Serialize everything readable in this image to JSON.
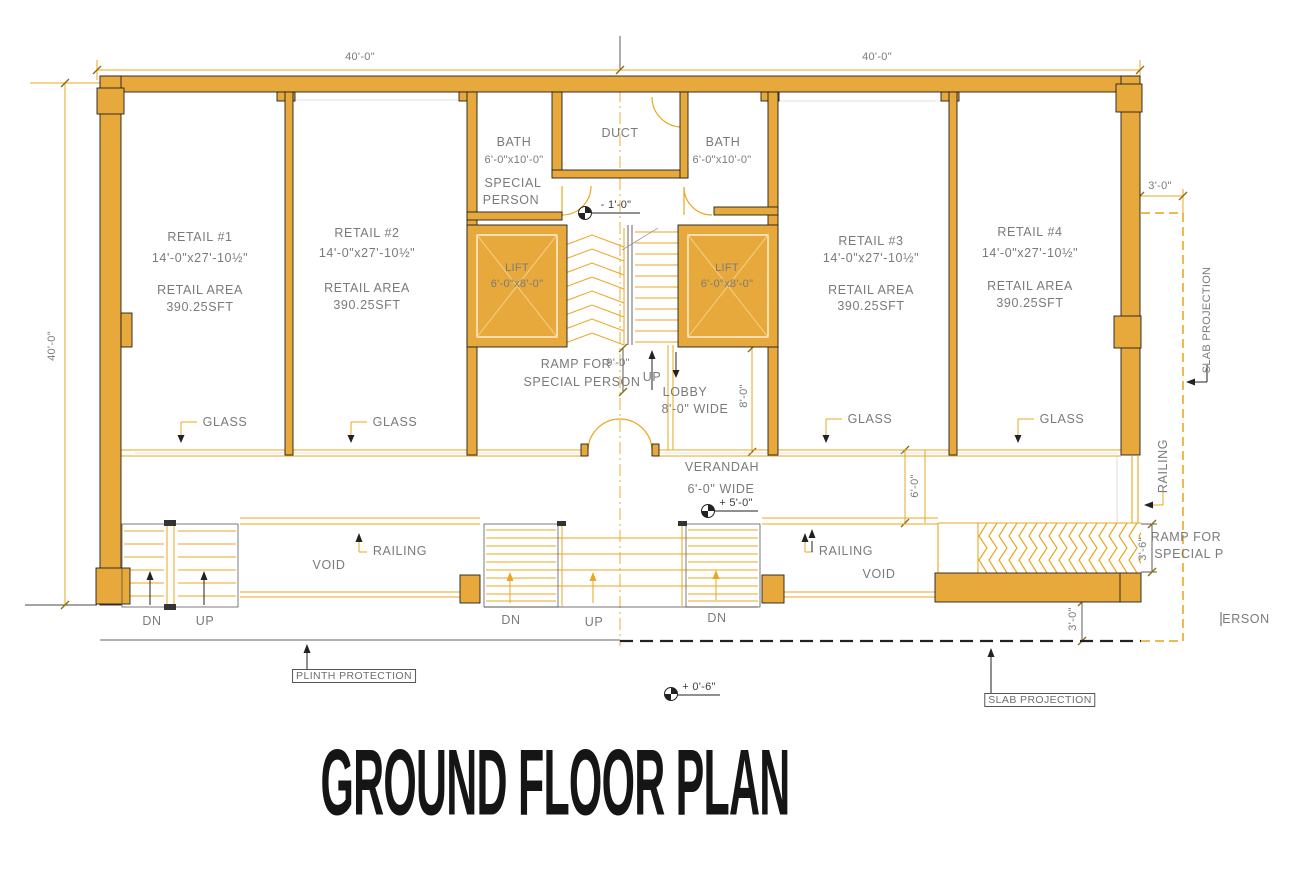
{
  "title": "GROUND FLOOR PLAN",
  "colors": {
    "wall": "#E8A93C",
    "line": "#EAA61F",
    "text": "#7A7A7A",
    "ink": "#1B1B1B"
  },
  "dimensions": {
    "top_left": "40'-0\"",
    "top_right": "40'-0\"",
    "left_side": "40'-0\"",
    "slab_offset_top": "3'-0\"",
    "slab_offset_bottom": "3'-0\"",
    "ramp_right_width": "3'-6\"",
    "verandah_depth": "6'-0\"",
    "lobby_depth": "8'-0\"",
    "ramp_length": "9'-0\""
  },
  "rooms": {
    "retail1": {
      "name": "RETAIL #1",
      "size": "14'-0\"x27'-10½\"",
      "area_label": "RETAIL AREA",
      "area": "390.25SFT"
    },
    "retail2": {
      "name": "RETAIL #2",
      "size": "14'-0\"x27'-10½\"",
      "area_label": "RETAIL AREA",
      "area": "390.25SFT"
    },
    "retail3": {
      "name": "RETAIL #3",
      "size": "14'-0\"x27'-10½\"",
      "area_label": "RETAIL AREA",
      "area": "390.25SFT"
    },
    "retail4": {
      "name": "RETAIL #4",
      "size": "14'-0\"x27'-10½\"",
      "area_label": "RETAIL AREA",
      "area": "390.25SFT"
    },
    "bath_left": {
      "name": "BATH",
      "size": "6'-0\"x10'-0\"",
      "note_line1": "SPECIAL",
      "note_line2": "PERSON"
    },
    "bath_right": {
      "name": "BATH",
      "size": "6'-0\"x10'-0\""
    },
    "duct": {
      "name": "DUCT"
    },
    "lift_left": {
      "name": "LIFT",
      "size": "6'-0\"x8'-0\""
    },
    "lift_right": {
      "name": "LIFT",
      "size": "6'-0\"x8'-0\""
    },
    "lobby": {
      "name": "LOBBY",
      "size": "8'-0\" WIDE"
    },
    "verandah": {
      "name": "VERANDAH",
      "size": "6'-0\" WIDE"
    }
  },
  "labels": {
    "ramp_center_line1": "RAMP FOR",
    "ramp_center_line2": "SPECIAL PERSON",
    "ramp_right_line1": "RAMP FOR",
    "ramp_right_line2": "SPECIAL P",
    "ramp_right_line3": "ERSON",
    "glass": "GLASS",
    "railing": "RAILING",
    "void": "VOID",
    "up": "UP",
    "dn": "DN",
    "plinth_protection": "PLINTH PROTECTION",
    "slab_projection": "SLAB PROJECTION"
  },
  "levels": {
    "entry_landing": "- 1'-0\"",
    "verandah_level": "+ 5'-0\"",
    "ground_level": "+ 0'-6\""
  }
}
